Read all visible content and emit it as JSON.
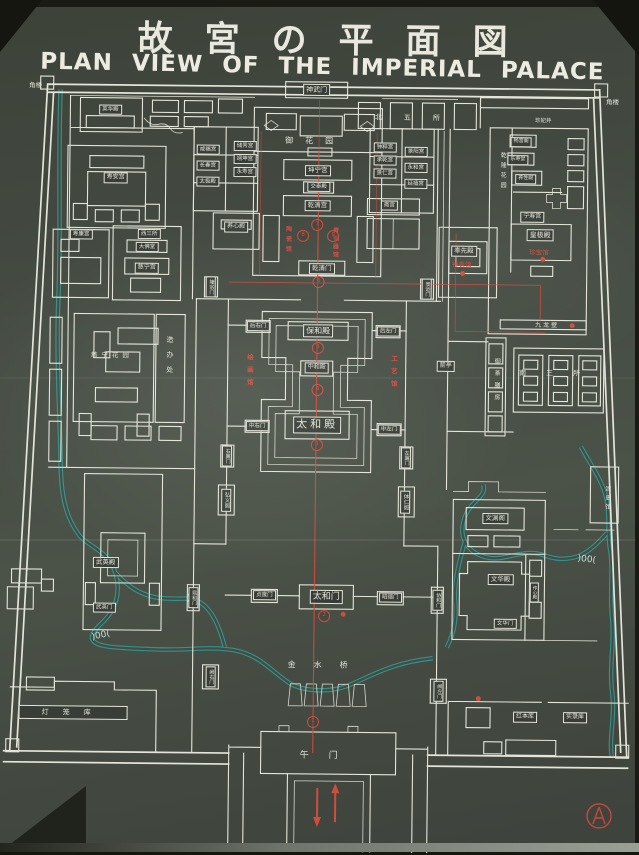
{
  "title": {
    "japanese": "故宮の平面図",
    "english": "PLAN VIEW OF THE IMPERIAL PALACE"
  },
  "map": {
    "colors": {
      "line": "#e4e5da",
      "red": "#d24c3c",
      "water": "#2f9f98",
      "board": "#454b43"
    },
    "labels": [
      {
        "id": "jiaolou-tl",
        "text": "角楼",
        "style": "spread",
        "x": 33,
        "y": 89,
        "fs": 6.5
      },
      {
        "id": "jiaolou-tr",
        "text": "角楼",
        "style": "spread",
        "x": 610,
        "y": 100,
        "fs": 6.5
      },
      {
        "id": "shenwumen",
        "text": "神武门",
        "style": "box",
        "x": 314,
        "y": 90,
        "fs": 7
      },
      {
        "id": "beiwusuo",
        "text": "北五所",
        "style": "spread",
        "x": 416,
        "y": 117,
        "fs": 7,
        "ls": 22
      },
      {
        "id": "yuhuayuan",
        "text": "御花园",
        "style": "spread",
        "x": 313,
        "y": 141,
        "fs": 8,
        "ls": 12
      },
      {
        "id": "kunninggong",
        "text": "坤宁宫",
        "style": "box",
        "x": 316,
        "y": 171,
        "fs": 6.5
      },
      {
        "id": "jiaotaidian",
        "text": "交泰殿",
        "style": "box",
        "x": 317,
        "y": 187,
        "fs": 5.5
      },
      {
        "id": "qianqinggong",
        "text": "乾清宫",
        "style": "box",
        "x": 316,
        "y": 206,
        "fs": 6.5
      },
      {
        "id": "taociguan",
        "text": "陶瓷馆",
        "style": "vred",
        "x": 286,
        "y": 241,
        "fs": 6,
        "ls": 4
      },
      {
        "id": "qingtongqiguan",
        "text": "青铜器馆",
        "style": "vred",
        "x": 333,
        "y": 243,
        "fs": 6,
        "ls": 2
      },
      {
        "id": "qianqingmen",
        "text": "乾清门",
        "style": "box",
        "x": 321,
        "y": 269,
        "fs": 6.5
      },
      {
        "id": "chuxiugong",
        "text": "储秀宫",
        "style": "box",
        "x": 243,
        "y": 147,
        "fs": 5.5
      },
      {
        "id": "yikungong",
        "text": "翊坤宫",
        "style": "box",
        "x": 243,
        "y": 160,
        "fs": 5.5
      },
      {
        "id": "yongshougong",
        "text": "永寿宫",
        "style": "box",
        "x": 243,
        "y": 173,
        "fs": 5.5
      },
      {
        "id": "xianfugong",
        "text": "咸福宫",
        "style": "box",
        "x": 206,
        "y": 151,
        "fs": 5.5
      },
      {
        "id": "changchungong",
        "text": "长春宫",
        "style": "box",
        "x": 206,
        "y": 167,
        "fs": 5.5
      },
      {
        "id": "taijidian",
        "text": "太极殿",
        "style": "box",
        "x": 206,
        "y": 183,
        "fs": 5.5
      },
      {
        "id": "yangxindian",
        "text": "养心殿",
        "style": "box",
        "x": 235,
        "y": 228,
        "fs": 6
      },
      {
        "id": "zhongcuigong",
        "text": "钟粹宫",
        "style": "box",
        "x": 383,
        "y": 147,
        "fs": 5.5
      },
      {
        "id": "chengqiangong",
        "text": "承乾宫",
        "style": "box",
        "x": 383,
        "y": 160,
        "fs": 5.5
      },
      {
        "id": "jingrengong",
        "text": "景仁宫",
        "style": "box",
        "x": 383,
        "y": 173,
        "fs": 5.5
      },
      {
        "id": "jingyanggong",
        "text": "景阳宫",
        "style": "box",
        "x": 414,
        "y": 151,
        "fs": 5.5
      },
      {
        "id": "yonghegong",
        "text": "永和宫",
        "style": "box",
        "x": 414,
        "y": 167,
        "fs": 5.5
      },
      {
        "id": "yanxigong",
        "text": "延禧宫",
        "style": "box",
        "x": 414,
        "y": 183,
        "fs": 5.5
      },
      {
        "id": "zhaigong",
        "text": "斋宫",
        "style": "box",
        "x": 388,
        "y": 205,
        "fs": 5.5
      },
      {
        "id": "yinghuadian",
        "text": "英华殿",
        "style": "box",
        "x": 108,
        "y": 112,
        "fs": 5.5
      },
      {
        "id": "shouangong",
        "text": "寿安宫",
        "style": "box",
        "x": 114,
        "y": 180,
        "fs": 6
      },
      {
        "id": "shoukanggong",
        "text": "寿康宫",
        "style": "box",
        "x": 80,
        "y": 237,
        "fs": 5.5
      },
      {
        "id": "xisansuo",
        "text": "西三所",
        "style": "box",
        "x": 148,
        "y": 236,
        "fs": 5.5
      },
      {
        "id": "dafotang",
        "text": "大佛堂",
        "style": "box",
        "x": 146,
        "y": 249,
        "fs": 5.5
      },
      {
        "id": "cininggong",
        "text": "慈宁宫",
        "style": "box",
        "x": 146,
        "y": 270,
        "fs": 6
      },
      {
        "id": "cininghuayuan",
        "text": "慈宁花园",
        "style": "spread",
        "x": 112,
        "y": 358,
        "fs": 6.5,
        "ls": 4
      },
      {
        "id": "zaobanchu",
        "text": "造办处",
        "style": "vplain",
        "x": 170,
        "y": 360,
        "fs": 7,
        "ls": 8
      },
      {
        "id": "fengxiandian",
        "text": "奉先殿",
        "style": "box",
        "x": 463,
        "y": 250,
        "fs": 6.5
      },
      {
        "id": "zhongbiaoguan",
        "text": "钟表馆",
        "style": "red",
        "x": 461,
        "y": 264,
        "fs": 6.5
      },
      {
        "id": "zhenfeijing",
        "text": "珍妃井",
        "style": "spread",
        "x": 541,
        "y": 119,
        "fs": 5.5
      },
      {
        "id": "changyinge",
        "text": "畅音阁",
        "style": "box",
        "x": 519,
        "y": 140,
        "fs": 5
      },
      {
        "id": "leshoutang",
        "text": "乐寿堂",
        "style": "box",
        "x": 516,
        "y": 158,
        "fs": 5
      },
      {
        "id": "yangxingdian",
        "text": "养性殿",
        "style": "box",
        "x": 524,
        "y": 177,
        "fs": 5
      },
      {
        "id": "qianlonghuayuan",
        "text": "乾隆花园",
        "style": "vplain",
        "x": 500,
        "y": 170,
        "fs": 6,
        "ls": 4
      },
      {
        "id": "ningshougong",
        "text": "宁寿宫",
        "style": "box",
        "x": 531,
        "y": 215,
        "fs": 6
      },
      {
        "id": "huangjidian",
        "text": "皇极殿",
        "style": "box",
        "x": 539,
        "y": 233,
        "fs": 7
      },
      {
        "id": "zhenbaoguan",
        "text": "珍宝馆",
        "style": "red",
        "x": 538,
        "y": 251,
        "fs": 6.5
      },
      {
        "id": "jiulongbi",
        "text": "九龙壁",
        "style": "spread",
        "x": 547,
        "y": 324,
        "fs": 6,
        "ls": 2
      },
      {
        "id": "yuchashanfang",
        "text": "御茶膳房",
        "style": "vplain",
        "x": 496,
        "y": 380,
        "fs": 6,
        "ls": 6
      },
      {
        "id": "nansansuo",
        "text": "南三所",
        "style": "spread",
        "x": 560,
        "y": 371,
        "fs": 7,
        "ls": 20
      },
      {
        "id": "jianting",
        "text": "箭亭",
        "style": "box",
        "x": 446,
        "y": 365,
        "fs": 6
      },
      {
        "id": "qingshiguan",
        "text": "清史馆",
        "style": "vplain",
        "x": 608,
        "y": 496,
        "fs": 6,
        "ls": 3
      },
      {
        "id": "longzongmen",
        "text": "隆宗门",
        "style": "vbox",
        "x": 210,
        "y": 288,
        "fs": 5
      },
      {
        "id": "jingyunmen",
        "text": "景运门",
        "style": "vbox",
        "x": 426,
        "y": 288,
        "fs": 5
      },
      {
        "id": "houyoumen",
        "text": "后右门",
        "style": "box",
        "x": 258,
        "y": 327,
        "fs": 5.5
      },
      {
        "id": "houzuomen",
        "text": "后左门",
        "style": "box",
        "x": 388,
        "y": 331,
        "fs": 5.5
      },
      {
        "id": "baohedian",
        "text": "保和殿",
        "style": "box",
        "x": 318,
        "y": 331,
        "fs": 8
      },
      {
        "id": "huihuaguan",
        "text": "绘画馆",
        "style": "vred",
        "x": 249,
        "y": 373,
        "fs": 6.5,
        "ls": 6
      },
      {
        "id": "gongyiguan",
        "text": "工艺馆",
        "style": "vred",
        "x": 393,
        "y": 373,
        "fs": 6.5,
        "ls": 6
      },
      {
        "id": "zhonghedian",
        "text": "中和殿",
        "style": "box",
        "x": 317,
        "y": 368,
        "fs": 6
      },
      {
        "id": "zhongyoumen",
        "text": "中右门",
        "style": "box",
        "x": 258,
        "y": 427,
        "fs": 5.5
      },
      {
        "id": "zhongzuomen",
        "text": "中左门",
        "style": "box",
        "x": 390,
        "y": 429,
        "fs": 5.5
      },
      {
        "id": "taihedian",
        "text": "太和殿",
        "style": "box",
        "x": 318,
        "y": 425,
        "fs": 11,
        "ls": 3
      },
      {
        "id": "youyimen",
        "text": "右翼门",
        "style": "vbox",
        "x": 228,
        "y": 457,
        "fs": 5
      },
      {
        "id": "zuoyimen",
        "text": "左翼门",
        "style": "vbox",
        "x": 407,
        "y": 457,
        "fs": 5
      },
      {
        "id": "hongyige",
        "text": "弘义阁",
        "style": "vbox",
        "x": 228,
        "y": 501,
        "fs": 5.5
      },
      {
        "id": "tirenge",
        "text": "体仁阁",
        "style": "vbox",
        "x": 407,
        "y": 501,
        "fs": 5.5
      },
      {
        "id": "wuyingdian",
        "text": "武英殿",
        "style": "box",
        "x": 108,
        "y": 565,
        "fs": 6.5
      },
      {
        "id": "wuyingmen",
        "text": "武英门",
        "style": "box",
        "x": 107,
        "y": 610,
        "fs": 5.5
      },
      {
        "id": "wenyuange",
        "text": "文渊阁",
        "style": "box",
        "x": 497,
        "y": 517,
        "fs": 6.5
      },
      {
        "id": "wenhuadian",
        "text": "文华殿",
        "style": "box",
        "x": 503,
        "y": 578,
        "fs": 6.5
      },
      {
        "id": "chuanxindian",
        "text": "传心殿",
        "style": "vbox",
        "x": 537,
        "y": 590,
        "fs": 4.5
      },
      {
        "id": "wenhuamen",
        "text": "文华门",
        "style": "box",
        "x": 508,
        "y": 622,
        "fs": 5.5
      },
      {
        "id": "xihemen",
        "text": "熙和门",
        "style": "vbox",
        "x": 196,
        "y": 599,
        "fs": 5
      },
      {
        "id": "xiehemen",
        "text": "协和门",
        "style": "vbox",
        "x": 440,
        "y": 599,
        "fs": 5
      },
      {
        "id": "zhendumen",
        "text": "贞度门",
        "style": "box",
        "x": 267,
        "y": 596,
        "fs": 5.5
      },
      {
        "id": "taihemen",
        "text": "太和门",
        "style": "box",
        "x": 329,
        "y": 597,
        "fs": 9
      },
      {
        "id": "zhaodemen",
        "text": "昭德门",
        "style": "box",
        "x": 393,
        "y": 597,
        "fs": 5.5
      },
      {
        "id": "jinshuiqiao",
        "text": "金水桥",
        "style": "spread",
        "x": 330,
        "y": 665,
        "fs": 8,
        "ls": 18
      },
      {
        "id": "wumen",
        "text": "午门",
        "style": "spread",
        "x": 333,
        "y": 756,
        "fs": 9,
        "ls": 20
      },
      {
        "id": "queyoumen",
        "text": "阙右门",
        "style": "vbox",
        "x": 214,
        "y": 678,
        "fs": 5
      },
      {
        "id": "quezuomen",
        "text": "阙左门",
        "style": "vbox",
        "x": 442,
        "y": 690,
        "fs": 5
      },
      {
        "id": "denglongku",
        "text": "灯笼库",
        "style": "wbox",
        "x": 77,
        "y": 715,
        "fs": 7,
        "ls": 14
      },
      {
        "id": "hongbenku",
        "text": "红本库",
        "style": "box",
        "x": 529,
        "y": 715,
        "fs": 6
      },
      {
        "id": "shiluku",
        "text": "实录库",
        "style": "box",
        "x": 579,
        "y": 715,
        "fs": 6
      }
    ],
    "axis_markers": [
      {
        "n": "1",
        "x": 317,
        "y": 722
      },
      {
        "n": "2",
        "x": 327,
        "y": 616
      },
      {
        "n": "3",
        "x": 318,
        "y": 445
      },
      {
        "n": "4",
        "x": 318,
        "y": 390
      },
      {
        "n": "5",
        "x": 318,
        "y": 348
      },
      {
        "n": "6",
        "x": 318,
        "y": 282
      },
      {
        "n": "7",
        "x": 316,
        "y": 225
      },
      {
        "n": "8",
        "x": 302,
        "y": 236
      },
      {
        "n": "9",
        "x": 332,
        "y": 236
      }
    ],
    "red_dots": [
      {
        "x": 462,
        "y": 272
      },
      {
        "x": 542,
        "y": 257
      },
      {
        "x": 572,
        "y": 323
      },
      {
        "x": 482,
        "y": 697
      },
      {
        "x": 346,
        "y": 614
      }
    ],
    "bridges": [
      {
        "t": ")00(",
        "x": 104,
        "y": 638,
        "r": -12
      },
      {
        "t": ")00(",
        "x": 589,
        "y": 557,
        "r": 6
      },
      {
        "t": ")(",
        "x": 193,
        "y": 600,
        "r": 0
      }
    ]
  }
}
